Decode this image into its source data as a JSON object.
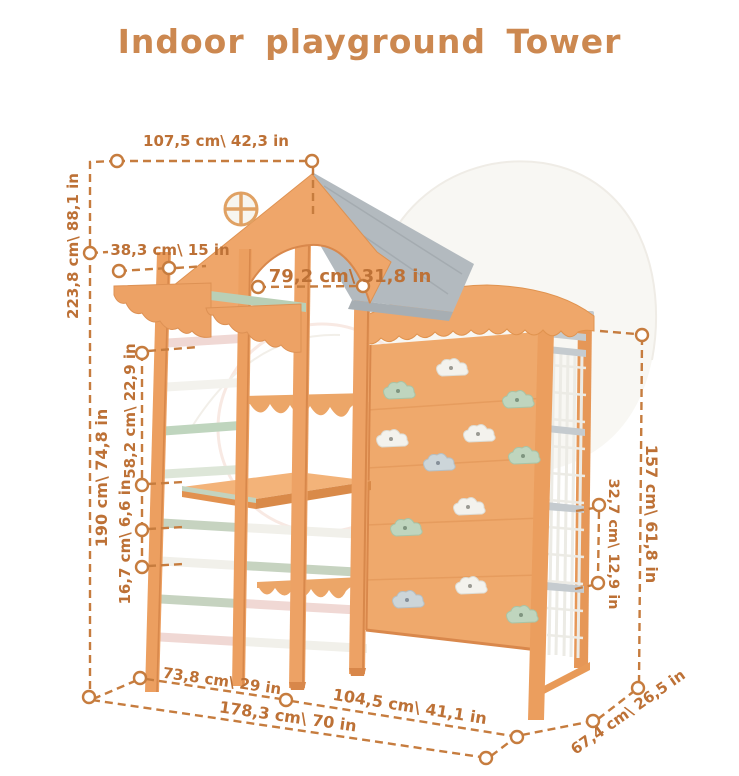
{
  "title": "Indoor playground Tower",
  "dims": {
    "top_width": "107,5 cm\\ 42,3 in",
    "overhang": "38,3 cm\\ 15 in",
    "inner_width": "79,2 cm\\ 31,8 in",
    "total_height": "223,8 cm\\ 88,1 in",
    "frame_height": "190 cm\\ 74,8 in",
    "upper_section": "58,2 cm\\ 22,9 in",
    "rung_spacing": "16,7 cm\\ 6,6 in",
    "left_width": "73,8 cm\\ 29 in",
    "total_width": "178,3 cm\\ 70 in",
    "wall_width": "104,5 cm\\ 41,1 in",
    "right_depth": "67,4 cm\\ 26,5 in",
    "right_height": "157 cm\\ 61,8 in",
    "net_section": "32,7 cm\\ 12,9 in"
  },
  "colors": {
    "title_text": "#cc8850",
    "dimension_lines": "#c67c3e",
    "dimension_text": "#bd7136",
    "wood": "#eda265",
    "wood_shadow": "#d8884b",
    "roof_gray": "#b3babf",
    "mint": "#bfd5be",
    "pink": "#f0d8d4",
    "white_parts": "#f3f2ed",
    "gray_blue": "#ccd5d9",
    "rope": "#ecebe5",
    "background": "#ffffff"
  }
}
